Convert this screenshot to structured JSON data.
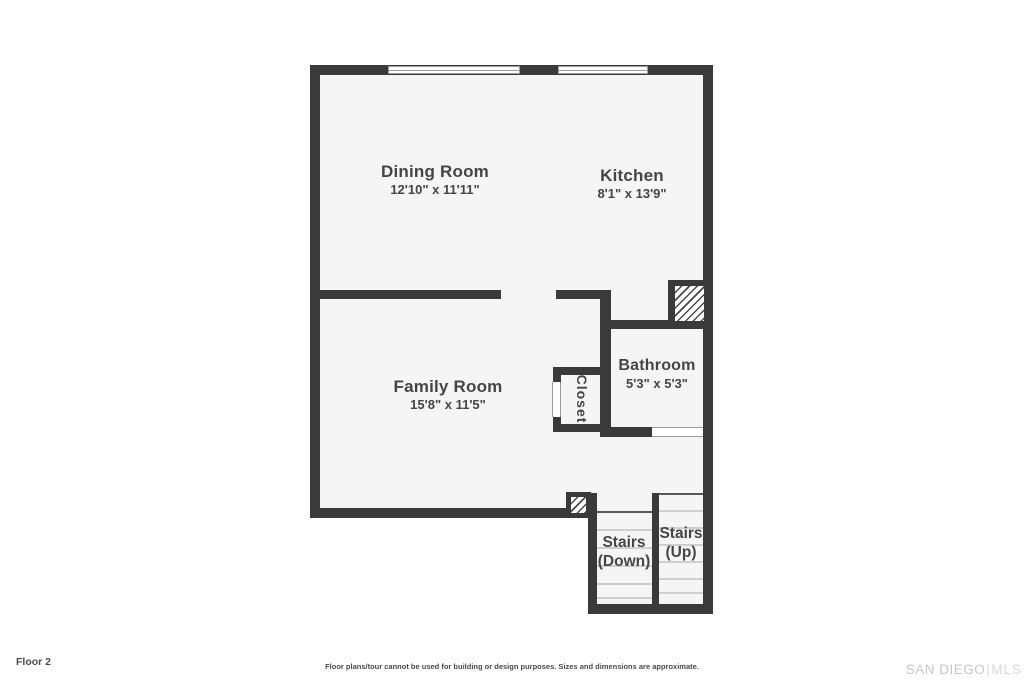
{
  "floor_plan": {
    "rooms": {
      "dining": {
        "name": "Dining Room",
        "dims": "12'10\" x 11'11\""
      },
      "kitchen": {
        "name": "Kitchen",
        "dims": "8'1\" x 13'9\""
      },
      "family": {
        "name": "Family Room",
        "dims": "15'8\" x 11'5\""
      },
      "bathroom": {
        "name": "Bathroom",
        "dims": "5'3\" x 5'3\""
      },
      "closet": {
        "name": "Closet"
      },
      "stairs_down": {
        "name": "Stairs",
        "qualifier": "(Down)"
      },
      "stairs_up": {
        "name": "Stairs",
        "qualifier": "(Up)"
      }
    }
  },
  "footer": {
    "floor_label": "Floor 2",
    "disclaimer": "Floor plans/tour cannot be used for building or design purposes. Sizes and dimensions are approximate.",
    "brand_primary": "SAN DIEGO",
    "brand_divider": "|",
    "brand_secondary": "MLS"
  },
  "colors": {
    "wall": "#3a3a3a",
    "floor": "#f5f5f5",
    "label": "#454545",
    "tread": "#cfcfcf",
    "brand": "#c7c7c7"
  }
}
